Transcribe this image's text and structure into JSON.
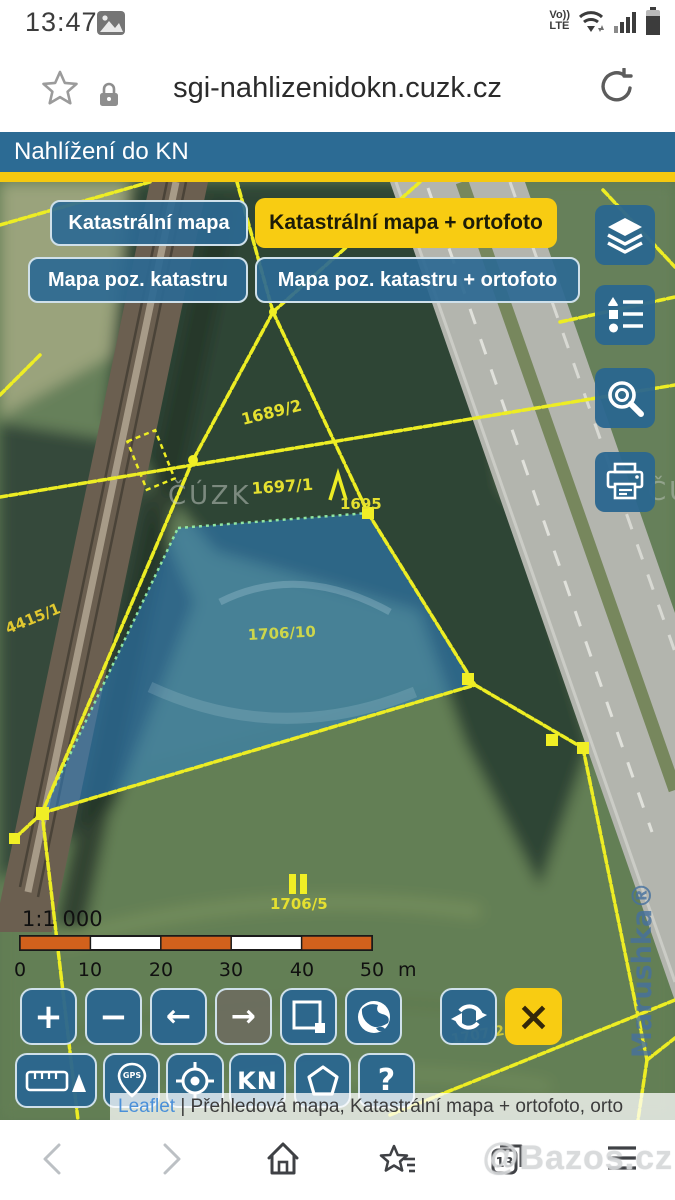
{
  "status_bar": {
    "time": "13:47",
    "carrier_volte": "Vo))",
    "carrier_lte": "LTE"
  },
  "browser": {
    "url": "sgi-nahlizenidokn.cuzk.cz"
  },
  "header": {
    "title": "Nahlížení do KN"
  },
  "layer_buttons": {
    "katastralni_mapa": "Katastrální mapa",
    "katastralni_mapa_ortofoto": "Katastrální mapa + ortofoto",
    "mapa_poz_katastru": "Mapa poz. katastru",
    "mapa_poz_katastru_ortofoto": "Mapa poz. katastru + ortofoto"
  },
  "map": {
    "parcel_labels": {
      "a": "1689/2",
      "b": "1697/1",
      "c": "1695",
      "d": "4415/1",
      "e": "1706/10",
      "f": "1706/5",
      "g": "1707/2"
    },
    "watermark_cuzk": "ČÚZK",
    "watermark_marushka": "Marushka®",
    "scale": {
      "ratio": "1:1 000",
      "ticks": [
        "0",
        "10",
        "20",
        "30",
        "40",
        "50"
      ],
      "unit": "m"
    }
  },
  "toolbar": {
    "zoom_in": "+",
    "zoom_out": "−",
    "left_arrow": "←",
    "right_arrow": "→",
    "close": "×",
    "kn": "KN",
    "help": "?",
    "gps": "GPS"
  },
  "attribution": {
    "leaflet": "Leaflet",
    "separator": " | ",
    "text": "Přehledová mapa, Katastrální mapa + ortofoto, orto"
  },
  "bottom_nav": {
    "tab_count": "13"
  },
  "watermark": {
    "at": "@",
    "text": "Bazos.cz"
  },
  "colors": {
    "header_blue": "#2c6b94",
    "accent_yellow": "#f6c90f",
    "cadastral_yellow": "#eded24",
    "parcel_fill": "#2e82c8",
    "link_blue": "#4a90d9"
  }
}
